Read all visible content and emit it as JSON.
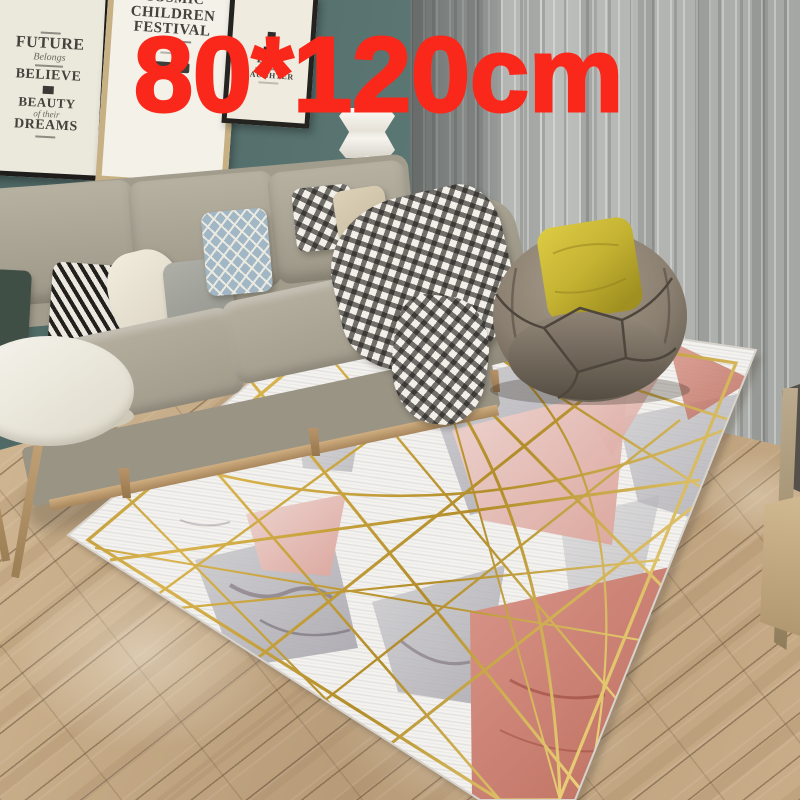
{
  "image_type": "e-commerce product photo of a geometric marble rug in a living room",
  "overlay": {
    "size_label": "80*120cm",
    "color": "#fa281a"
  },
  "posters": {
    "dreams": {
      "word_future": "FUTURE",
      "script_belongs": "Belongs",
      "word_believe": "BELIEVE",
      "word_beauty": "BEAUTY",
      "script_of_their": "of their",
      "word_dreams": "DREAMS"
    },
    "festival": {
      "line1": "COSMIC",
      "line2": "CHILDREN",
      "line3": "FESTIVAL"
    },
    "day": {
      "line1": "DAY",
      "line2": "LAUGHTER"
    }
  },
  "palette": {
    "wall": "#5a736f",
    "curtain": "#b5b8b5",
    "floor_wood": "#c4aa89",
    "sofa_fabric": "#a8a293",
    "rug_base": "#f2f1ef",
    "rug_gold": "#c5a13d",
    "rug_pink": "#dfab9f",
    "rug_red": "#c87f70",
    "rug_gray": "#b3b1b7",
    "beanbag": "#8b8073",
    "pillow_yellow": "#d5c43a",
    "blanket_check": "#191714"
  }
}
